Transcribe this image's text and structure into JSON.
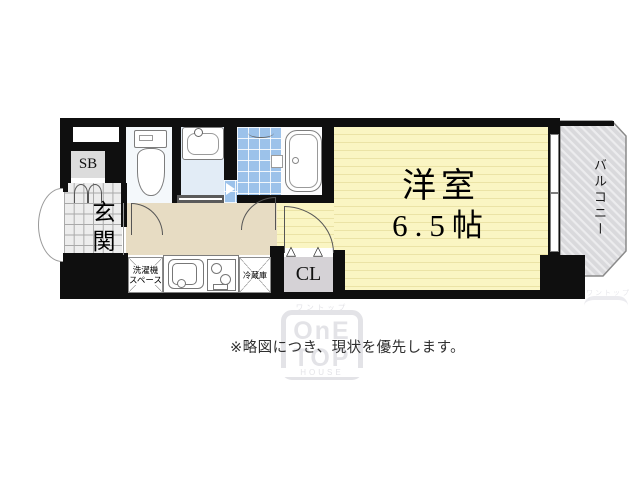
{
  "note": "※略図につき、現状を優先します。",
  "rooms": {
    "western": {
      "name": "洋室",
      "size": "6.5帖"
    },
    "entrance": "玄関",
    "balcony": "バルコニー",
    "shoe_box": "SB",
    "closet": "CL",
    "washer_line1": "洗濯機",
    "washer_line2": "スペース",
    "fridge": "冷蔵庫"
  },
  "icons": {
    "closet_door_triangle": "△"
  },
  "watermark": {
    "katakana": "ワントップ",
    "row1": "OnE",
    "row2": "TOP",
    "house": "HOUSE"
  },
  "colors": {
    "wall": "#0f0f0f",
    "room_floor": "#faf5c3",
    "room_stripe": "#ebe3a6",
    "hall_floor": "#e7dcc3",
    "entrance_tile": "#ededed",
    "bath_tile": "#9cc2ea",
    "washroom_floor": "#e2ecf6",
    "closet_fill": "#d5d2d6",
    "balcony_fill": "#d9d9dc",
    "watermark": "#e3e3e7",
    "note_text": "#2f2f2f"
  }
}
